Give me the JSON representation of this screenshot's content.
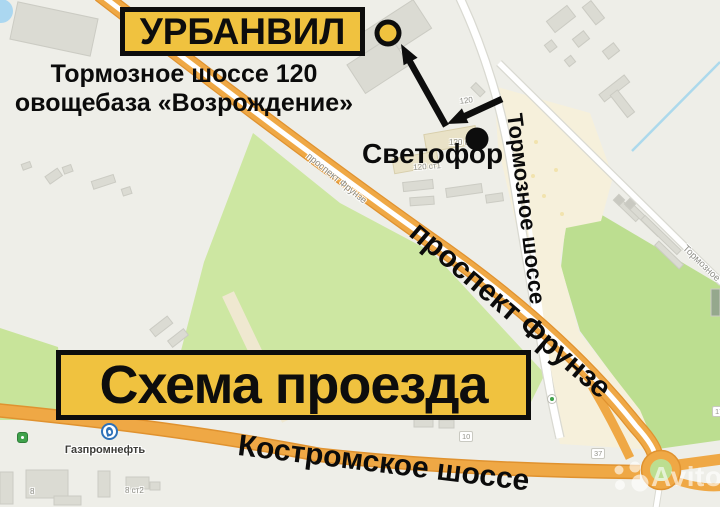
{
  "marker_box": {
    "label": "УРБАНВИЛ"
  },
  "address": {
    "line1": "Тормозное шоссе 120",
    "line2": "овощебаза «Возрождение»"
  },
  "scheme": {
    "title": "Схема проезда"
  },
  "annotations": {
    "traffic_light": "Светофор",
    "tormoznoe_big": "Тормозное шоссе",
    "frunze_big": "проспект Фрунзе",
    "kostromskoe_big": "Костромское шоссе"
  },
  "map_labels": {
    "frunze_small": "проспект Фрунзе",
    "tormoznoe_small": "Тормозное",
    "bld_120": "120",
    "bld_120_st": "120 ст",
    "bld_120_st1": "120 ст1",
    "bld_8": "8",
    "bld_8_st2": "8 ст2",
    "badge_37": "37",
    "badge_10": "10",
    "badge_17": "17",
    "gazprom": "Газпромнефть"
  },
  "watermark": {
    "brand": "Avito"
  },
  "colors": {
    "accent_yellow": "#F0C23F",
    "road_orange": "#EFA845",
    "map_background": "#EEEEE8",
    "field_green": "#CDE7A2",
    "forest_green": "#BCDE90",
    "beige": "#F6F0DB",
    "black": "#0D0D0D"
  }
}
